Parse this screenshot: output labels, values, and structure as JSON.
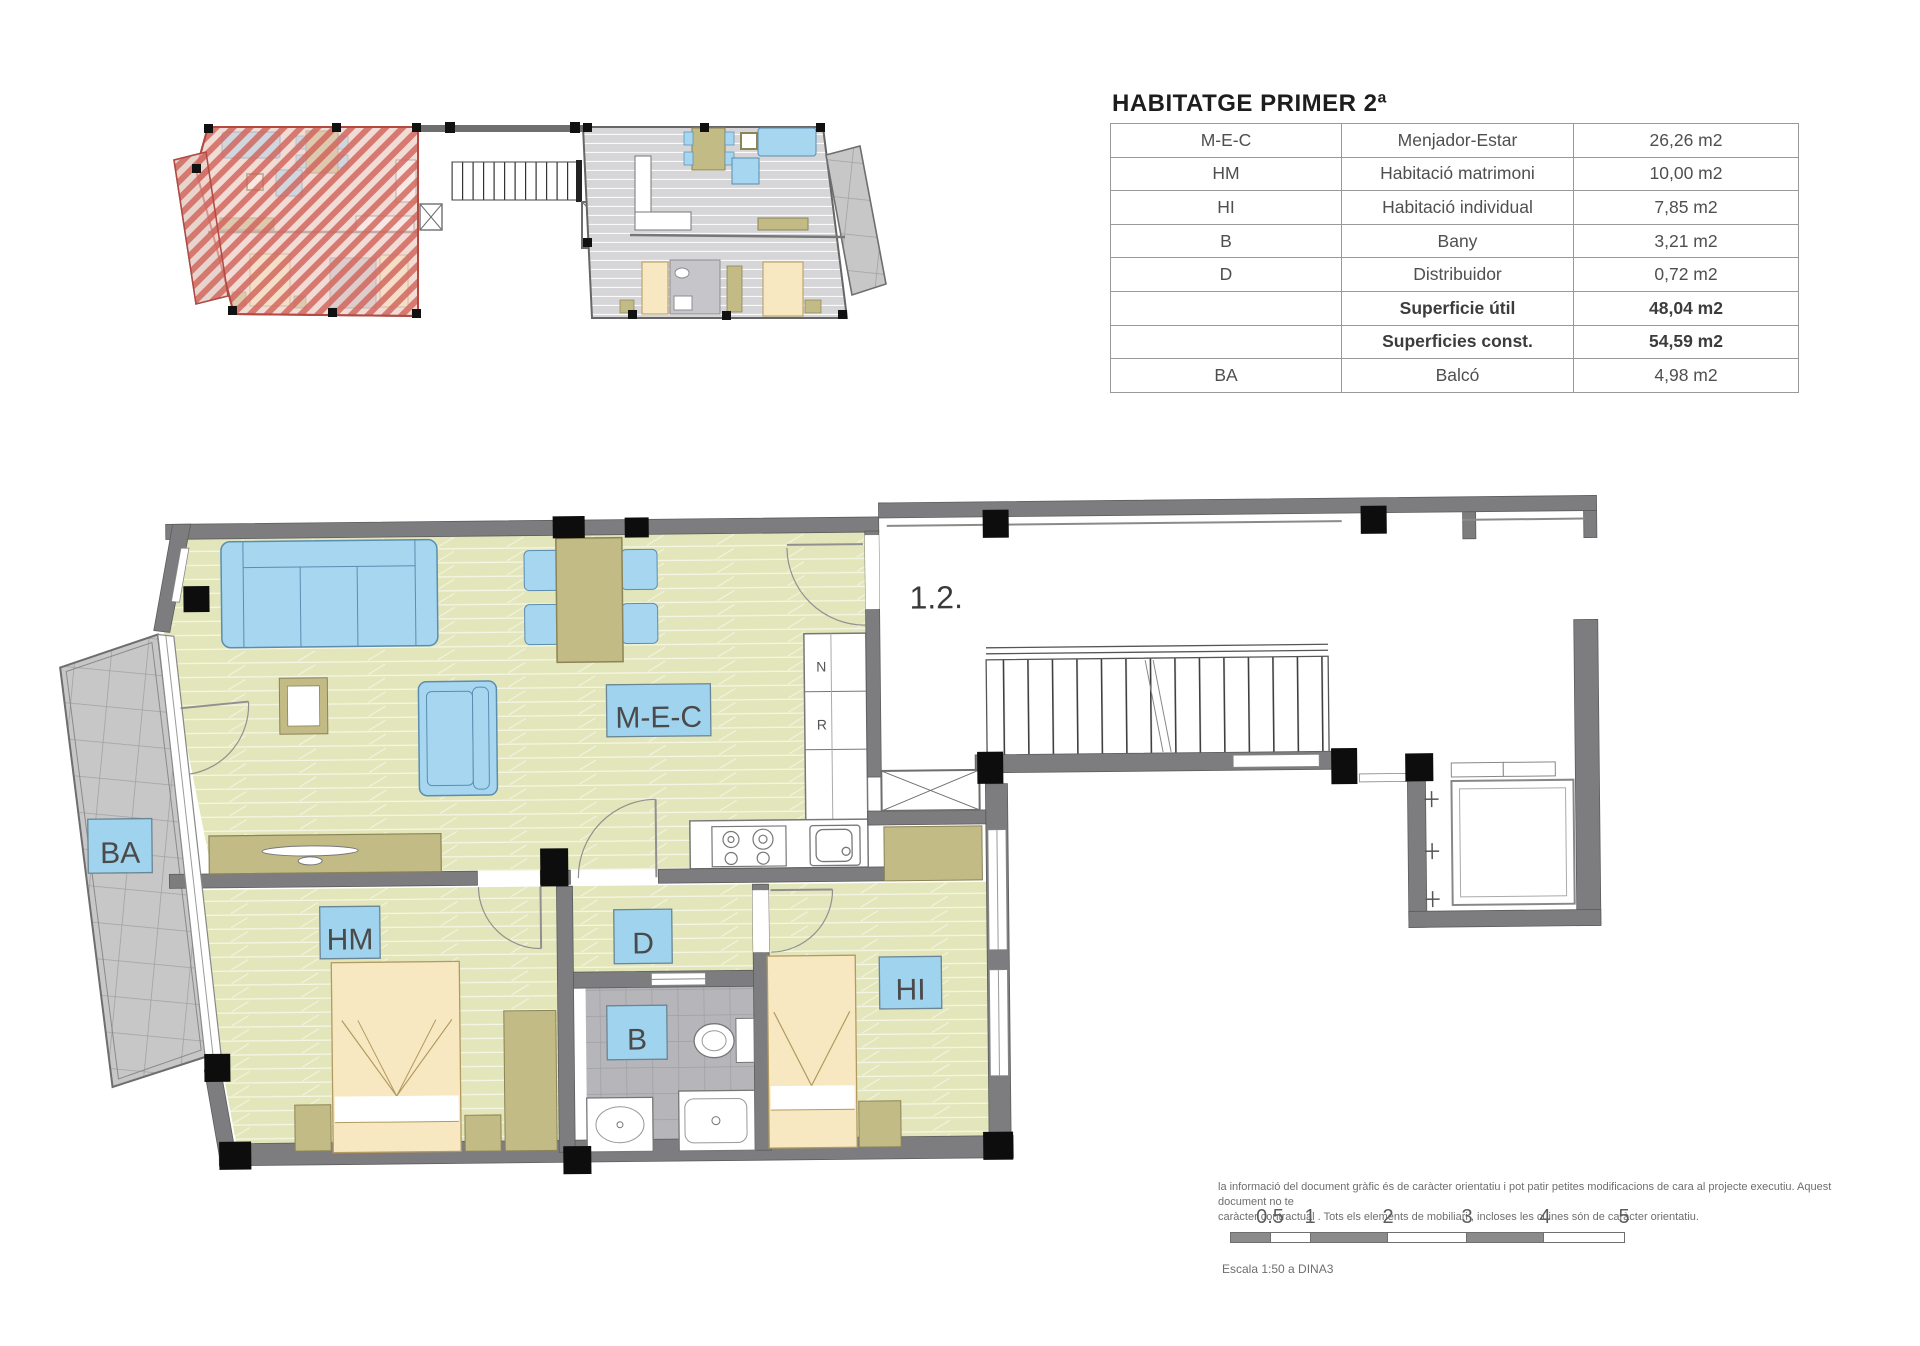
{
  "header": {
    "title": "HABITATGE PRIMER 2ª"
  },
  "area_table": {
    "rows": [
      {
        "code": "M-E-C",
        "concept": "Menjador-Estar",
        "value": "26,26 m2"
      },
      {
        "code": "HM",
        "concept": "Habitació matrimoni",
        "value": "10,00 m2"
      },
      {
        "code": "HI",
        "concept": "Habitació individual",
        "value": "7,85 m2"
      },
      {
        "code": "B",
        "concept": "Bany",
        "value": "3,21 m2"
      },
      {
        "code": "D",
        "concept": "Distribuidor",
        "value": "0,72 m2"
      },
      {
        "code": "",
        "concept": "Superficie útil",
        "value": "48,04 m2"
      },
      {
        "code": "",
        "concept": "Superficies const.",
        "value": "54,59 m2"
      },
      {
        "code": "BA",
        "concept": "Balcó",
        "value": "4,98 m2"
      }
    ]
  },
  "floor_plan": {
    "unit_number": "1.2.",
    "labels": {
      "mec": "M-E-C",
      "ba": "BA",
      "hm": "HM",
      "d": "D",
      "b": "B",
      "hi": "HI"
    },
    "appliances": {
      "fridge": "N",
      "washer": "R"
    }
  },
  "footer": {
    "disclaimer_line1": "la informació del document gràfic és de caràcter orientatiu i pot patir petites modificacions de cara al projecte executiu. Aquest document no te",
    "disclaimer_line2": "caràcter contractual . Tots els elements de mobiliari , incloses les cuines són de caràcter orientatiu.",
    "scale_ticks": [
      "0.5",
      "1",
      "2",
      "3",
      "4",
      "5"
    ],
    "scale_caption": "Escala 1:50 a DINA3"
  },
  "colors": {
    "floor": "#e3e6ba",
    "wall": "#7d7d7f",
    "label_blue": "#9fd3ee",
    "furniture_blue": "#a6d6f0",
    "wood_tan": "#c3bb85",
    "bed_cream": "#f8e8c2",
    "tile_gray": "#b6b6ba",
    "balcony_gray": "#c7c7c7",
    "highlight_red": "#cf6257"
  }
}
